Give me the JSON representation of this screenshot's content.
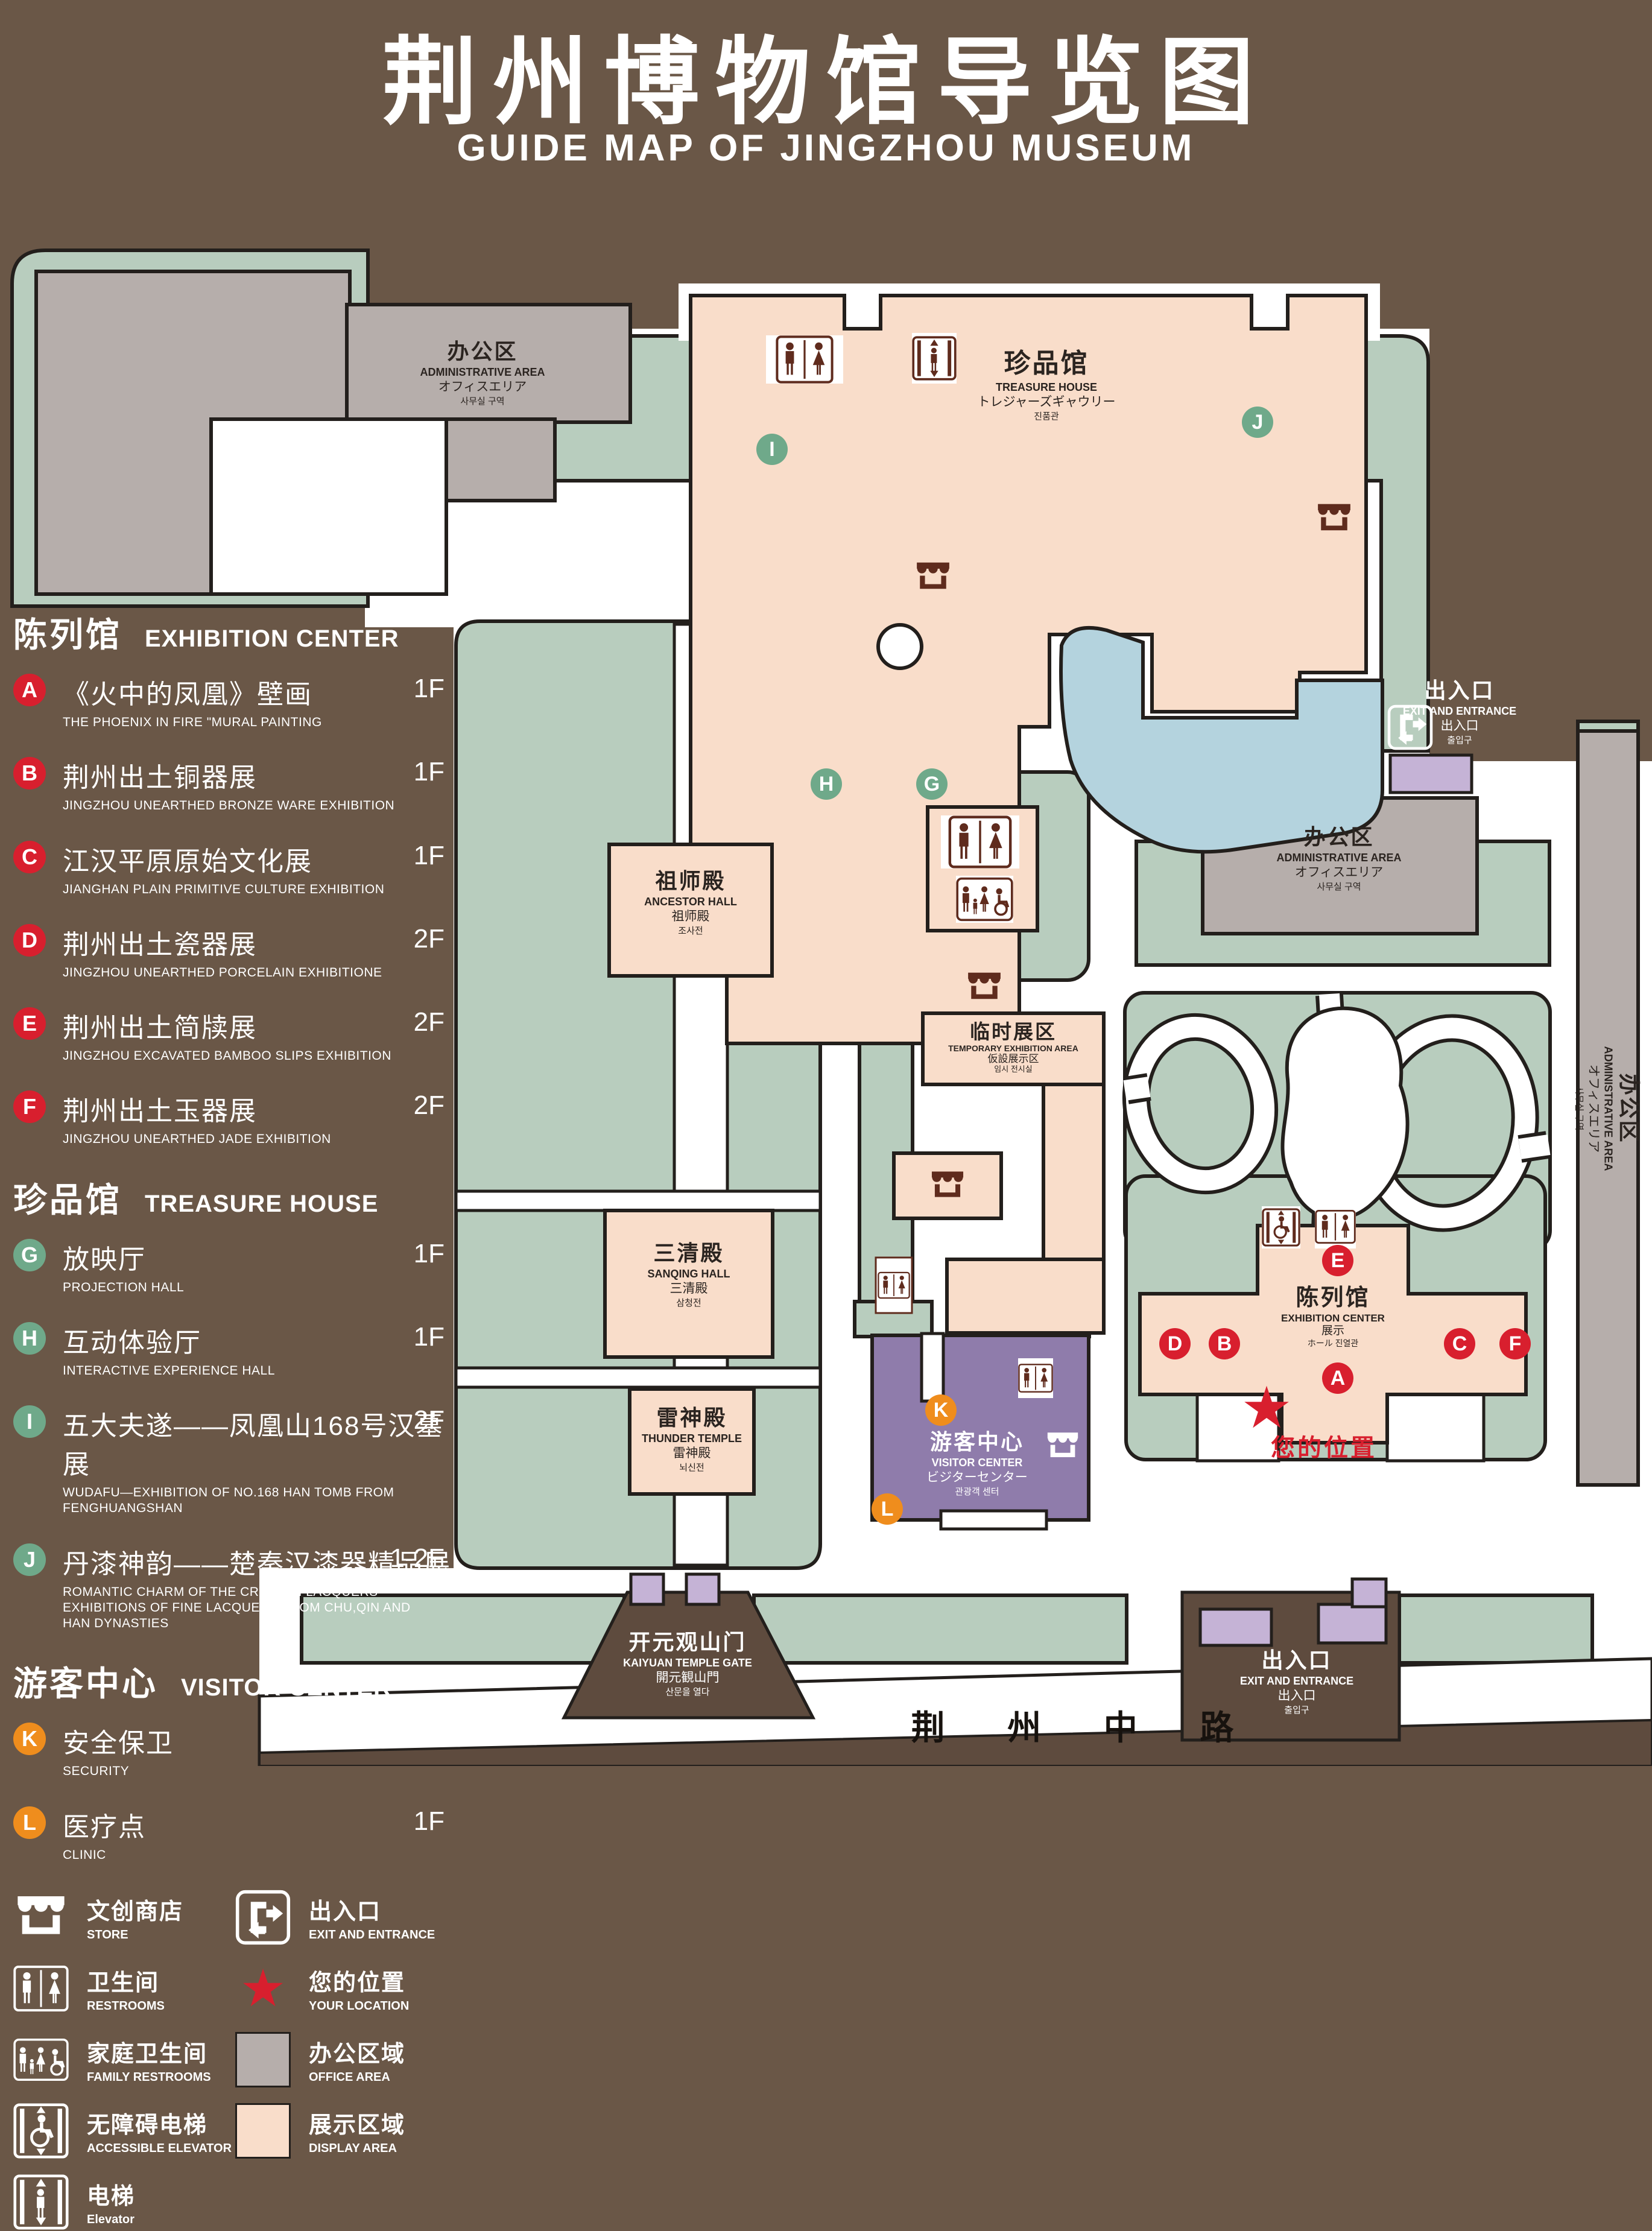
{
  "title": {
    "zh": "荆州博物馆导览图",
    "en": "GUIDE MAP OF JINGZHOU MUSEUM"
  },
  "legend": {
    "sections": [
      {
        "zh": "陈列馆",
        "en": "EXHIBITION CENTER",
        "items": [
          {
            "id": "A",
            "zh": "《火中的凤凰》壁画",
            "en": "THE PHOENIX IN FIRE \"MURAL PAINTING",
            "floor": "1F"
          },
          {
            "id": "B",
            "zh": "荆州出土铜器展",
            "en": "JINGZHOU UNEARTHED BRONZE WARE EXHIBITION",
            "floor": "1F"
          },
          {
            "id": "C",
            "zh": "江汉平原原始文化展",
            "en": "JIANGHAN PLAIN PRIMITIVE CULTURE EXHIBITION",
            "floor": "1F"
          },
          {
            "id": "D",
            "zh": "荆州出土瓷器展",
            "en": "JINGZHOU UNEARTHED PORCELAIN EXHIBITIONE",
            "floor": "2F"
          },
          {
            "id": "E",
            "zh": "荆州出土简牍展",
            "en": "JINGZHOU EXCAVATED BAMBOO SLIPS EXHIBITION",
            "floor": "2F"
          },
          {
            "id": "F",
            "zh": "荆州出土玉器展",
            "en": "JINGZHOU UNEARTHED JADE EXHIBITION",
            "floor": "2F"
          }
        ]
      },
      {
        "zh": "珍品馆",
        "en": "TREASURE HOUSE",
        "items": [
          {
            "id": "G",
            "zh": "放映厅",
            "en": "PROJECTION HALL",
            "floor": "1F"
          },
          {
            "id": "H",
            "zh": "互动体验厅",
            "en": "INTERACTIVE EXPERIENCE HALL",
            "floor": "1F"
          },
          {
            "id": "I",
            "zh": "五大夫遂——凤凰山168号汉墓展",
            "en": "WUDAFU—EXHIBITION OF NO.168 HAN TOMB FROM FENGHUANGSHAN",
            "floor": "2F"
          },
          {
            "id": "J",
            "zh": "丹漆神韵——楚秦汉漆器精品展",
            "en": "ROMANTIC CHARM OF THE CRIMSON LACQUERS—EXHIBITIONS OF FINE LACQUERS FROM CHU,QIN AND HAN DYNASTIES",
            "floor": "1-2F"
          }
        ]
      },
      {
        "zh": "游客中心",
        "en": "VISITOR CENTER",
        "items": [
          {
            "id": "K",
            "zh": "安全保卫",
            "en": "SECURITY",
            "floor": "1F"
          },
          {
            "id": "L",
            "zh": "医疗点",
            "en": "CLINIC",
            "floor": "1F"
          }
        ]
      }
    ],
    "symbols": {
      "store": {
        "zh": "文创商店",
        "en": "STORE"
      },
      "exit": {
        "zh": "出入口",
        "en": "EXIT AND ENTRANCE"
      },
      "restrooms": {
        "zh": "卫生间",
        "en": "RESTROOMS"
      },
      "location": {
        "zh": "您的位置",
        "en": "YOUR LOCATION"
      },
      "family": {
        "zh": "家庭卫生间",
        "en": "FAMILY RESTROOMS"
      },
      "office": {
        "zh": "办公区域",
        "en": "OFFICE AREA"
      },
      "accessible": {
        "zh": "无障碍电梯",
        "en": "ACCESSIBLE ELEVATOR"
      },
      "display": {
        "zh": "展示区域",
        "en": "DISPLAY AREA"
      },
      "elevator": {
        "zh": "电梯",
        "en": "Elevator"
      }
    }
  },
  "map": {
    "treasure": {
      "zh": "珍品馆",
      "en": "TREASURE HOUSE",
      "jp": "トレジャーズギャウリー",
      "kr": "진품관"
    },
    "admin": {
      "zh": "办公区",
      "en": "ADMINISTRATIVE AREA",
      "jp": "オフィスエリア",
      "kr": "사무실 구역"
    },
    "ancestor": {
      "zh": "祖师殿",
      "en": "ANCESTOR HALL",
      "jp": "祖师殿",
      "kr": "조사전"
    },
    "sanqing": {
      "zh": "三清殿",
      "en": "SANQING HALL",
      "jp": "三清殿",
      "kr": "삼청전"
    },
    "thunder": {
      "zh": "雷神殿",
      "en": "THUNDER TEMPLE",
      "jp": "雷神殿",
      "kr": "뇌신전"
    },
    "temporary": {
      "zh": "临时展区",
      "en": "TEMPORARY EXHIBITION AREA",
      "jp": "仮設展示区",
      "kr": "임시 전시실"
    },
    "visitor": {
      "zh": "游客中心",
      "en": "VISITOR CENTER",
      "jp": "ビジターセンター",
      "kr": "관광객 센터"
    },
    "exhibition": {
      "zh": "陈列馆",
      "en": "EXHIBITION CENTER",
      "jp": "展示",
      "kr": "ホール 진열관"
    },
    "exit": {
      "zh": "出入口",
      "en": "EXIT AND ENTRANCE",
      "jp": "出入口",
      "kr": "출입구"
    },
    "gate": {
      "zh": "开元观山门",
      "en": "KAIYUAN TEMPLE GATE",
      "jp": "開元観山門",
      "kr": "산문을 열다"
    },
    "road": "荆 州 中 路",
    "location": "您的位置",
    "markers": {
      "A": "A",
      "B": "B",
      "C": "C",
      "D": "D",
      "E": "E",
      "F": "F",
      "G": "G",
      "H": "H",
      "I": "I",
      "J": "J",
      "K": "K",
      "L": "L"
    }
  },
  "colors": {
    "background": "#6a5747",
    "landscape_green": "#b8cdbe",
    "display_pink": "#f9ddca",
    "office_gray": "#b6aeab",
    "lake_blue": "#b4d3de",
    "visitor_purple": "#8f7cab",
    "gate_purple": "#c5b3d6",
    "badge_red": "#d81f2e",
    "badge_green": "#6fa98a",
    "badge_orange": "#ef8d1d",
    "icon_maroon": "#5f2b1d",
    "road_brown": "#5e4b3e"
  }
}
